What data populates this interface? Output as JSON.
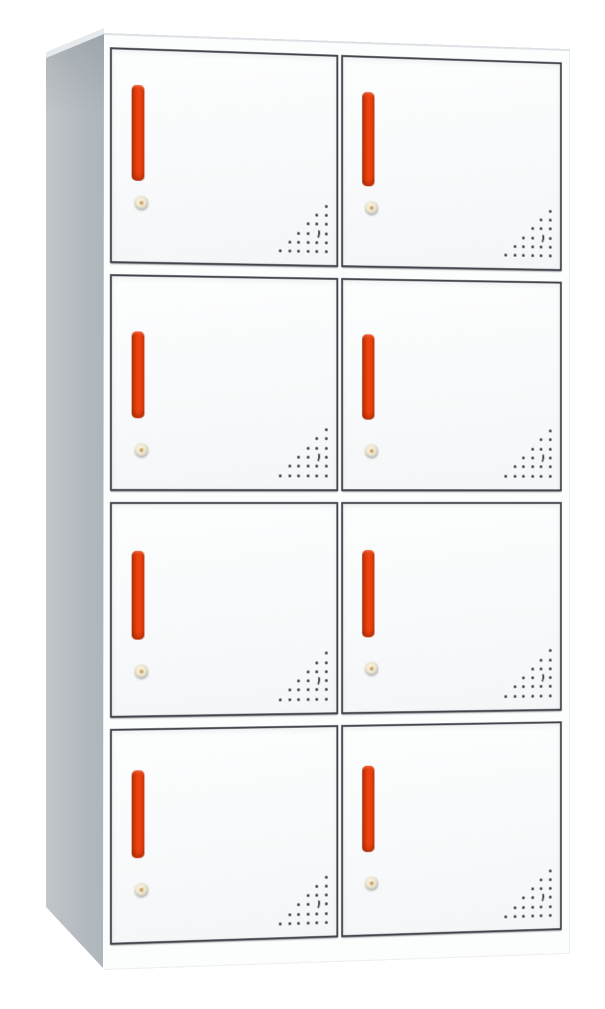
{
  "scene": {
    "description": "Product photograph of a steel locker cabinet with eight compartments (4 rows x 2 columns), shown at a slight left-side perspective on a white background. No text is visible.",
    "background_color": "#ffffff",
    "width": 605,
    "height": 1009
  },
  "cabinet": {
    "type": "8-door metal locker cabinet",
    "rows": 4,
    "columns": 2,
    "door_count": 8,
    "colors": {
      "body_white": "#fcfdfd",
      "side_panel_gray": "#b7bdc2",
      "door_face": "#f6f8f9",
      "door_border": "#41464c",
      "handle_red": "#ef440f",
      "handle_dark_red": "#9c2a08",
      "lock_brass": "#efe9d2",
      "lock_pin_orange": "#c79552",
      "vent_hole": "#383d43"
    },
    "front": {
      "left": 104,
      "top": 33,
      "width": 488,
      "height": 937,
      "rotate_y_deg": 8.4,
      "perspective_px": 2000
    },
    "side_panel": {
      "left": 46,
      "top": 28,
      "width": 58,
      "height": 940
    },
    "grid": {
      "row_gap": 11,
      "column_gap": 3,
      "padding": {
        "top": 12,
        "right": 8,
        "bottom": 24,
        "left": 6
      }
    },
    "handle": {
      "left": 20,
      "width": 13,
      "corner_radius": 5
    },
    "lock": {
      "left": 23,
      "diameter": 14
    },
    "vent": {
      "right": 9,
      "bottom": 12,
      "dot_size": 3,
      "dx": 9.6,
      "dy": 9.3,
      "rows_dot_counts": [
        1,
        2,
        3,
        4,
        5,
        6
      ],
      "alignment": "right-aligned triangle in lower-right corner of each door",
      "crescent": {
        "row": 4,
        "from_right": 2
      }
    },
    "rows_spec": [
      {
        "row": 1,
        "handle_top": 35,
        "handle_height": 96,
        "lock_top": 146
      },
      {
        "row": 2,
        "handle_top": 55,
        "handle_height": 87,
        "lock_top": 167
      },
      {
        "row": 3,
        "handle_top": 47,
        "handle_height": 89,
        "lock_top": 161
      },
      {
        "row": 4,
        "handle_top": 40,
        "handle_height": 88,
        "lock_top": 153
      }
    ],
    "doors": [
      {
        "id": 1,
        "row": 1,
        "column": "left"
      },
      {
        "id": 2,
        "row": 1,
        "column": "right"
      },
      {
        "id": 3,
        "row": 2,
        "column": "left"
      },
      {
        "id": 4,
        "row": 2,
        "column": "right"
      },
      {
        "id": 5,
        "row": 3,
        "column": "left"
      },
      {
        "id": 6,
        "row": 3,
        "column": "right"
      },
      {
        "id": 7,
        "row": 4,
        "column": "left"
      },
      {
        "id": 8,
        "row": 4,
        "column": "right"
      }
    ]
  }
}
